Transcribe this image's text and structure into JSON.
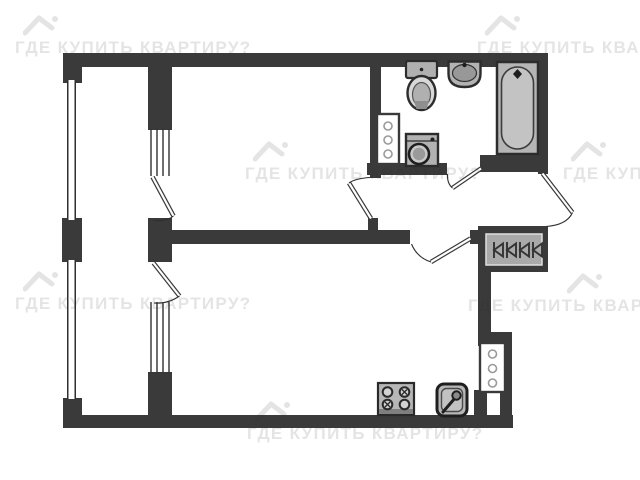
{
  "watermark": {
    "text": "ГДЕ КУПИТЬ КВАРТИРУ?",
    "tiles": [
      {
        "x": 15,
        "y": 14,
        "logo_dx": 8
      },
      {
        "x": 477,
        "y": 14,
        "logo_dx": 8
      },
      {
        "x": 245,
        "y": 140,
        "logo_dx": 8
      },
      {
        "x": 563,
        "y": 140,
        "logo_dx": 8
      },
      {
        "x": 15,
        "y": 270,
        "logo_dx": 8
      },
      {
        "x": 468,
        "y": 272,
        "logo_dx": 99
      },
      {
        "x": 247,
        "y": 400,
        "logo_dx": 8
      }
    ]
  },
  "colors": {
    "wall": "#3a3a3a",
    "fixture_fill": "#b5b5b5",
    "fixture_stroke": "#2c2c2c",
    "watermark": "rgba(45,45,45,0.13)"
  }
}
